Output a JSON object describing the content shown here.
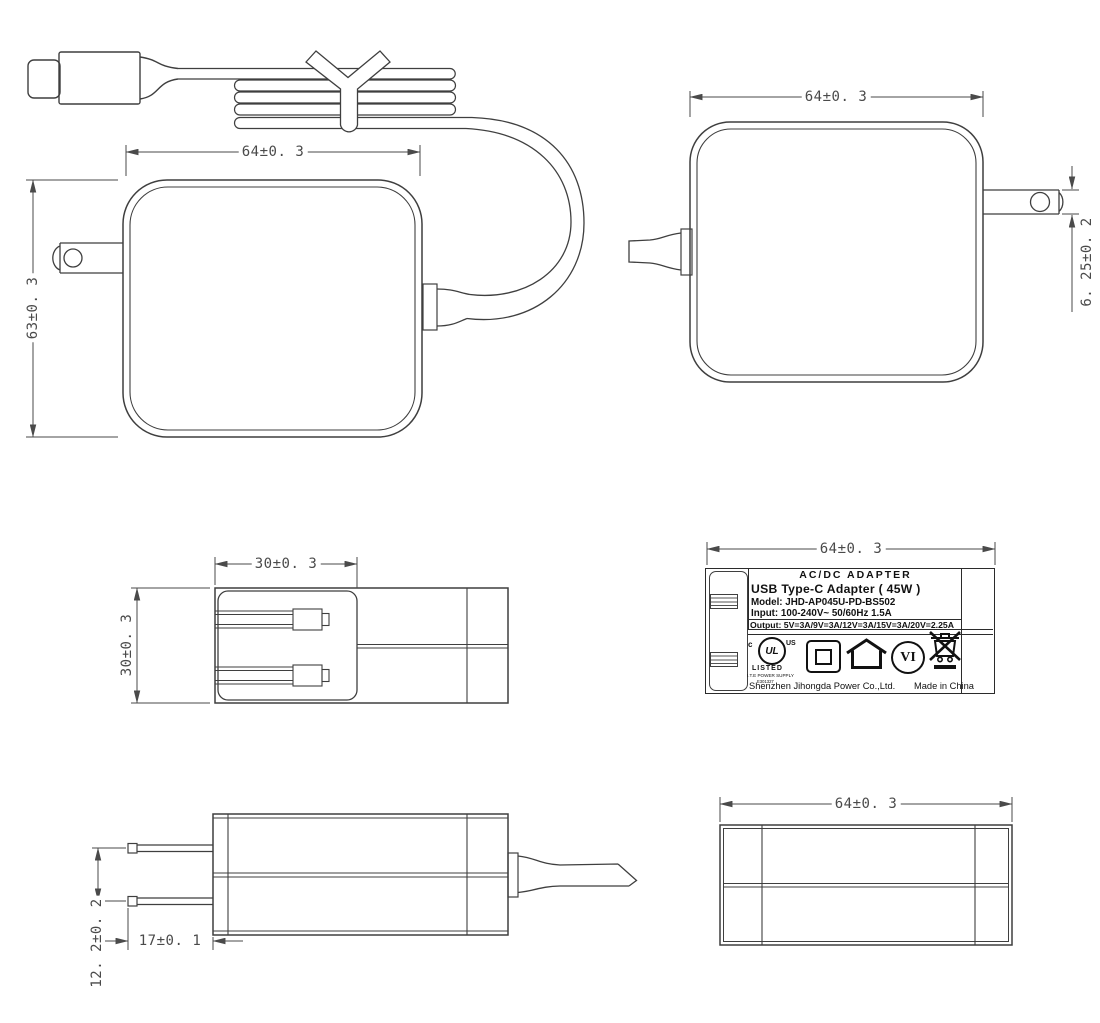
{
  "page": {
    "background": "#ffffff",
    "line_color": "#3f3f3f",
    "dim_color": "#4a4a4a"
  },
  "dimensions": {
    "front_width": "64±0. 3",
    "front_height": "63±0. 3",
    "back_width": "64±0. 3",
    "prong_thickness": "6. 25±0. 2",
    "plug_width": "30±0. 3",
    "top_depth": "30±0. 3",
    "label_width": "64±0. 3",
    "prong_pitch": "12. 2±0. 2",
    "prong_length": "17±0. 1",
    "bottom_width": "64±0. 3"
  },
  "label": {
    "title": "AC/DC  ADAPTER",
    "product": "USB Type-C Adapter ( 45W )",
    "model": "Model: JHD-AP045U-PD-BS502",
    "input": "Input: 100-240V~  50/60Hz  1.5A",
    "output": "Output: 5V=3A/9V=3A/12V=3A/15V=3A/20V=2.25A",
    "company": "Shenzhen Jihongda Power Co.,Ltd.",
    "origin": "Made in China",
    "efficiency": "VI",
    "ul": {
      "c": "c",
      "mark": "UL",
      "us": "US",
      "listed": "LISTED",
      "type": "I.T.E POWER SUPPLY",
      "file": "E301327"
    }
  },
  "icons": {
    "ul_listed": "ul-listed-icon",
    "class_ii": "class-ii-double-insulation-icon",
    "indoor_use": "indoor-use-house-icon",
    "efficiency_vi": "efficiency-level-vi-icon",
    "weee": "weee-crossed-bin-icon"
  }
}
